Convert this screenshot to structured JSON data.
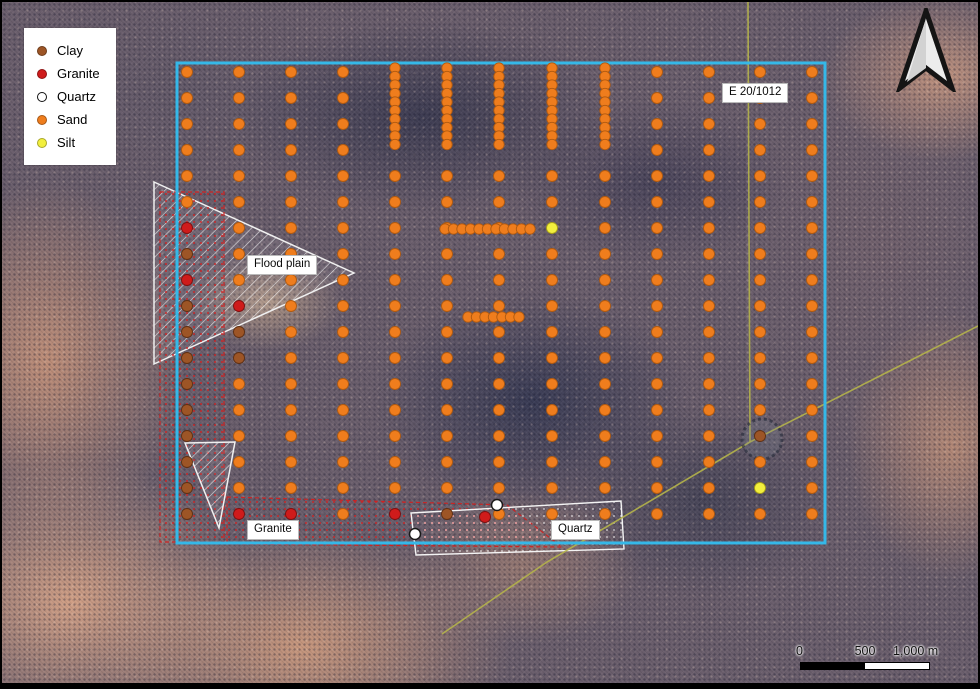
{
  "legend": {
    "items": [
      {
        "label": "Clay",
        "type": "clay",
        "color": "#9d5526"
      },
      {
        "label": "Granite",
        "type": "granite",
        "color": "#cf1b1b"
      },
      {
        "label": "Quartz",
        "type": "quartz",
        "color": "#ffffff",
        "ring": true
      },
      {
        "label": "Sand",
        "type": "sand",
        "color": "#ef7d1d"
      },
      {
        "label": "Silt",
        "type": "silt",
        "color": "#f2ef3d"
      }
    ]
  },
  "scale_bar": {
    "labels": [
      "0",
      "500",
      "1,000 m"
    ]
  },
  "north_arrow": {
    "icon": "north-arrow"
  },
  "map_labels": [
    {
      "id": "flood-plain",
      "text": "Flood plain",
      "x": 245,
      "y": 253
    },
    {
      "id": "granite-zone",
      "text": "Granite",
      "x": 245,
      "y": 518
    },
    {
      "id": "quartz-zone",
      "text": "Quartz",
      "x": 549,
      "y": 518
    },
    {
      "id": "tenement-id",
      "text": "E 20/1012",
      "x": 720,
      "y": 81
    }
  ],
  "colors": {
    "boundary": "#35b8e8",
    "tenement_line": "#b5b44a",
    "zone_red": "#cc2323",
    "sand": "#ef7d1d",
    "clay": "#9d5526",
    "granite": "#cf1b1b",
    "silt": "#f2ef3d",
    "quartz": "#ffffff"
  },
  "map_features": {
    "boundary": {
      "x": 175,
      "y": 61,
      "width": 648,
      "height": 480
    },
    "tenement_lines": [
      {
        "points": "746,0 748,440"
      },
      {
        "points": "980,322 748,440 545,560 440,632"
      }
    ],
    "circle_feature": {
      "cx": 760,
      "cy": 437,
      "r": 20
    },
    "zones": [
      {
        "name": "flood-plain-area",
        "points": "152,180 352,271 152,362",
        "pattern": "hatch-white"
      },
      {
        "name": "red-area-west",
        "points": "158,190 222,190 222,540 158,540",
        "pattern": "dots-red"
      },
      {
        "name": "granite-area",
        "points": "225,495 505,503 560,545 225,542",
        "pattern": "dots-red"
      },
      {
        "name": "white-triangle-area",
        "points": "183,441 233,440 217,526",
        "pattern": "hatch-white"
      },
      {
        "name": "quartz-area",
        "points": "409,511 619,499 622,547 414,553",
        "pattern": "dots-white"
      }
    ],
    "grid": {
      "cols": [
        185,
        237,
        289,
        341,
        393,
        445,
        497,
        550,
        603,
        655,
        707,
        758,
        810
      ],
      "rows": [
        70,
        96,
        122,
        148,
        174,
        200,
        226,
        252,
        278,
        304,
        330,
        356,
        382,
        408,
        434,
        460,
        486,
        512
      ],
      "dot_radius": 5.5,
      "skip": {
        "col_indices": [
          4,
          5,
          6,
          7,
          8
        ],
        "row_indices": [
          0,
          1,
          2,
          3
        ]
      },
      "overrides": [
        {
          "x": 185,
          "y": 226,
          "type": "granite"
        },
        {
          "x": 185,
          "y": 252,
          "type": "clay"
        },
        {
          "x": 185,
          "y": 278,
          "type": "granite"
        },
        {
          "x": 185,
          "y": 304,
          "type": "clay"
        },
        {
          "x": 185,
          "y": 330,
          "type": "clay"
        },
        {
          "x": 185,
          "y": 356,
          "type": "clay"
        },
        {
          "x": 185,
          "y": 382,
          "type": "clay"
        },
        {
          "x": 185,
          "y": 408,
          "type": "clay"
        },
        {
          "x": 185,
          "y": 434,
          "type": "clay"
        },
        {
          "x": 185,
          "y": 460,
          "type": "clay"
        },
        {
          "x": 185,
          "y": 486,
          "type": "clay"
        },
        {
          "x": 185,
          "y": 512,
          "type": "clay"
        },
        {
          "x": 237,
          "y": 304,
          "type": "granite"
        },
        {
          "x": 237,
          "y": 330,
          "type": "clay"
        },
        {
          "x": 237,
          "y": 356,
          "type": "clay"
        },
        {
          "x": 237,
          "y": 512,
          "type": "granite"
        },
        {
          "x": 289,
          "y": 512,
          "type": "granite"
        },
        {
          "x": 393,
          "y": 512,
          "type": "granite"
        },
        {
          "x": 445,
          "y": 512,
          "type": "clay"
        },
        {
          "x": 550,
          "y": 226,
          "type": "silt"
        },
        {
          "x": 758,
          "y": 434,
          "type": "clay"
        },
        {
          "x": 758,
          "y": 486,
          "type": "silt"
        }
      ]
    },
    "dense_vertical": {
      "xs": [
        393,
        445,
        497,
        550,
        603
      ],
      "y1": 66,
      "y2": 150,
      "step": 8.5,
      "radius": 5.2
    },
    "dense_horizontal": [
      {
        "y": 227,
        "x1": 443,
        "x2": 536,
        "step": 8.5,
        "radius": 5.2
      },
      {
        "y": 315,
        "x1": 466,
        "x2": 518,
        "step": 8.5,
        "radius": 5.2
      }
    ],
    "extra_dots": [
      {
        "x": 483,
        "y": 515,
        "type": "granite"
      },
      {
        "x": 413,
        "y": 532,
        "type": "quartz"
      },
      {
        "x": 495,
        "y": 503,
        "type": "quartz"
      }
    ]
  }
}
